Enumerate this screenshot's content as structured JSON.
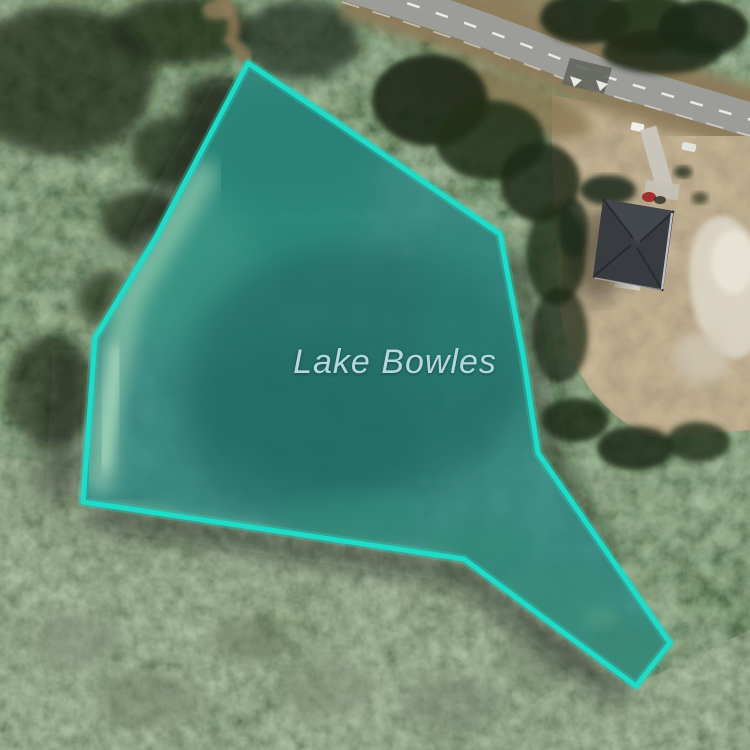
{
  "map": {
    "label": {
      "text": "Lake Bowles",
      "color": "#b6d8dc"
    },
    "overlay": {
      "polygon_points": "248,63 333,120 500,234 523,355 538,453 670,643 636,686 464,559 83,502 95,338 156,237",
      "stroke_color": "#1fdcc9",
      "glow_color": "rgba(31,220,201,0.30)",
      "fill_color": "rgba(47,217,200,0.25)"
    },
    "imagery": {
      "kind": "satellite",
      "road_color": "#9c9d99",
      "forest_color": "#2c3a24",
      "water_color": "#1c4a48"
    }
  }
}
